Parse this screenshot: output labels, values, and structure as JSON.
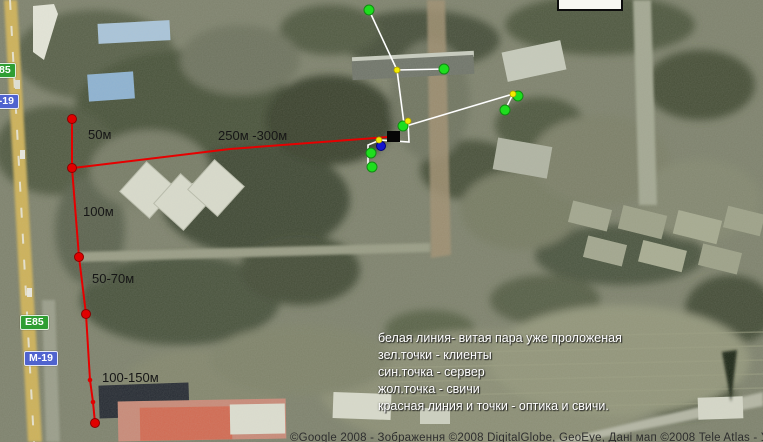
{
  "map": {
    "attribution": "©Google 2008 - Зображення ©2008 DigitalGlobe, GeoEye, Дані мап ©2008 Tele Atlas - Умови",
    "road_badges": [
      {
        "label": "E85",
        "type": "green",
        "x": -13,
        "y": 63
      },
      {
        "label": "M-19",
        "type": "blue",
        "x": -15,
        "y": 94
      },
      {
        "label": "E85",
        "type": "green",
        "x": 20,
        "y": 315
      },
      {
        "label": "M-19",
        "type": "blue",
        "x": 24,
        "y": 351
      }
    ]
  },
  "legend": {
    "x": 378,
    "y": 330,
    "lines": [
      "белая линия- витая пара уже проложеная",
      "зел.точки - клиенты",
      "син.точка - сервер",
      "жол.точка - свичи",
      "красная линия и точки - оптика и свичи."
    ]
  },
  "network": {
    "colors": {
      "red": "#e60000",
      "white": "#ffffff",
      "green": "#1ede1e",
      "yellow": "#f2ec00",
      "blue": "#1515cf",
      "black": "#060606"
    },
    "red_trunk": [
      [
        73,
        168
      ],
      [
        230,
        149
      ],
      [
        388,
        137
      ]
    ],
    "red_path": [
      [
        72,
        119
      ],
      [
        72,
        168
      ],
      [
        79,
        257
      ],
      [
        86,
        314
      ],
      [
        90,
        380
      ],
      [
        93,
        402
      ],
      [
        95,
        423
      ]
    ],
    "red_dots_large": [
      [
        72,
        119
      ],
      [
        72,
        168
      ],
      [
        79,
        257
      ],
      [
        86,
        314
      ],
      [
        95,
        423
      ]
    ],
    "red_dots_small": [
      [
        90,
        380
      ],
      [
        93,
        402
      ]
    ],
    "white_paths": [
      [
        [
          369,
          10
        ],
        [
          397,
          70
        ]
      ],
      [
        [
          397,
          70
        ],
        [
          444,
          69
        ]
      ],
      [
        [
          397,
          70
        ],
        [
          404,
          124
        ]
      ],
      [
        [
          406,
          126
        ],
        [
          513,
          94
        ]
      ],
      [
        [
          513,
          94
        ],
        [
          505,
          110
        ]
      ],
      [
        [
          408,
          121
        ],
        [
          409,
          142
        ],
        [
          380,
          140
        ],
        [
          368,
          145
        ],
        [
          368,
          167
        ],
        [
          372,
          166
        ]
      ]
    ],
    "green_dots": [
      [
        369,
        10
      ],
      [
        444,
        69
      ],
      [
        403,
        126
      ],
      [
        518,
        96
      ],
      [
        505,
        110
      ],
      [
        371,
        153
      ],
      [
        372,
        167
      ]
    ],
    "yellow_dots": [
      [
        397,
        70
      ],
      [
        408,
        121
      ],
      [
        379,
        140
      ],
      [
        513,
        94
      ]
    ],
    "blue_dot": [
      381,
      146
    ],
    "black_square": {
      "x": 387,
      "y": 131,
      "w": 13,
      "h": 11
    },
    "distance_labels": [
      {
        "text": "50м",
        "x": 88,
        "y": 139
      },
      {
        "text": "250м -300м",
        "x": 218,
        "y": 140
      },
      {
        "text": "100м",
        "x": 83,
        "y": 216
      },
      {
        "text": "50-70м",
        "x": 92,
        "y": 283
      },
      {
        "text": "100-150м",
        "x": 102,
        "y": 382
      }
    ]
  }
}
